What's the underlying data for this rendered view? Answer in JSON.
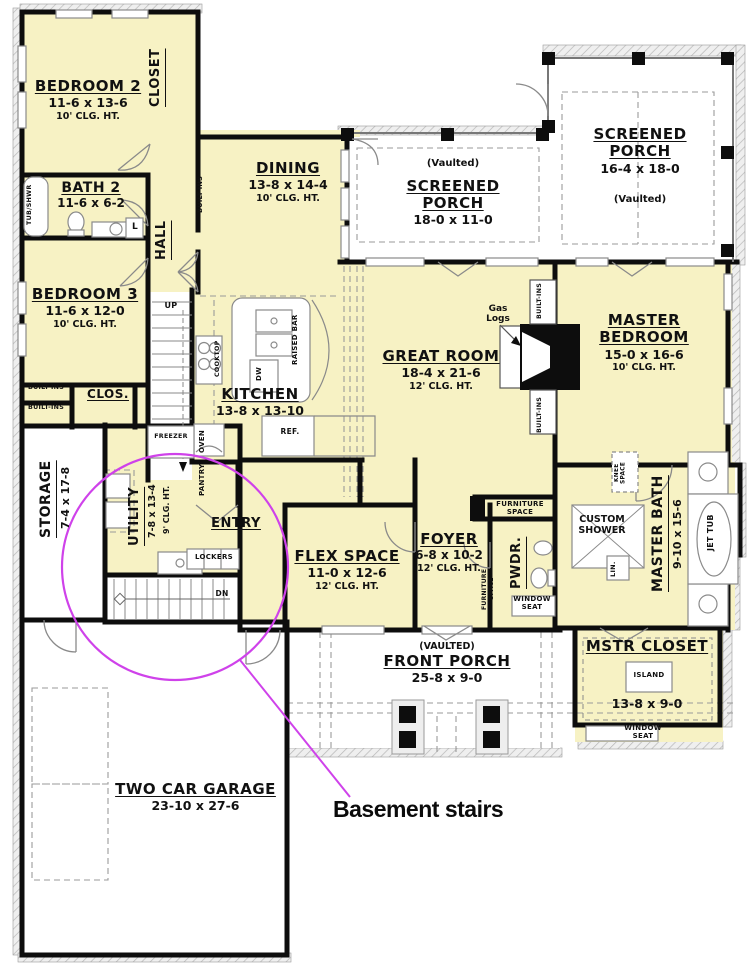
{
  "annotation": {
    "label": "Basement stairs"
  },
  "palette": {
    "room_fill": "#f7f2c4",
    "wall": "#0d0d0d",
    "porch_fill": "#ffffff",
    "annotation": "#cf42ea"
  },
  "rooms": {
    "bedroom2": {
      "name": "BEDROOM 2",
      "dims": "11-6 x 13-6",
      "ceiling": "10' CLG. HT."
    },
    "closet2": {
      "name": "CLOSET"
    },
    "bath2": {
      "name": "BATH 2",
      "dims": "11-6 x 6-2"
    },
    "hall": {
      "name": "HALL"
    },
    "bedroom3": {
      "name": "BEDROOM 3",
      "dims": "11-6 x 12-0",
      "ceiling": "10' CLG. HT."
    },
    "clos3": {
      "name": "CLOS."
    },
    "dining": {
      "name": "DINING",
      "dims": "13-8 x 14-4",
      "ceiling": "10' CLG. HT."
    },
    "screened_porch_center": {
      "name": "SCREENED PORCH",
      "dims": "18-0 x 11-0",
      "note": "(Vaulted)"
    },
    "screened_porch_right": {
      "name": "SCREENED PORCH",
      "dims": "16-4 x 18-0",
      "note": "(Vaulted)"
    },
    "great_room": {
      "name": "GREAT ROOM",
      "dims": "18-4 x 21-6",
      "ceiling": "12' CLG. HT."
    },
    "master_bedroom": {
      "name": "MASTER BEDROOM",
      "dims": "15-0 x 16-6",
      "ceiling": "10' CLG. HT."
    },
    "kitchen": {
      "name": "KITCHEN",
      "dims": "13-8 x 13-10"
    },
    "storage": {
      "name": "STORAGE",
      "dims": "7-4 x 17-8"
    },
    "utility": {
      "name": "UTILITY",
      "dims": "7-8 x 13-4",
      "ceiling": "9' CLG. HT."
    },
    "entry": {
      "name": "ENTRY"
    },
    "flex_space": {
      "name": "FLEX SPACE",
      "dims": "11-0 x 12-6",
      "ceiling": "12' CLG. HT."
    },
    "foyer": {
      "name": "FOYER",
      "dims": "6-8 x 10-2",
      "ceiling": "12' CLG. HT."
    },
    "powder": {
      "name": "PWDR."
    },
    "master_bath": {
      "name": "MASTER BATH",
      "dims": "9-10 x 15-6"
    },
    "custom_shower": {
      "name": "CUSTOM SHOWER"
    },
    "master_closet": {
      "name": "MSTR CLOSET",
      "dims": "13-8 x 9-0"
    },
    "front_porch": {
      "name": "FRONT PORCH",
      "dims": "25-8 x 9-0",
      "note": "(VAULTED)"
    },
    "garage": {
      "name": "TWO CAR GARAGE",
      "dims": "23-10 x 27-6"
    }
  },
  "features": {
    "built_ins": "BUILT-INS",
    "tub_shwr": "TUB/SHWR",
    "linen": "L",
    "up": "UP",
    "dn": "DN",
    "cooktop": "COOKTOP",
    "oven": "OVEN",
    "freezer": "FREEZER",
    "pantry": "PANTRY",
    "refrigerator": "REF.",
    "dishwasher": "DW",
    "raised_bar": "RAISED BAR",
    "lockers": "LOCKERS",
    "gas_logs": "Gas Logs",
    "furniture_space": "FURNITURE SPACE",
    "window_seat": "WINDOW SEAT",
    "knee_space": "KNEE SPACE",
    "lin": "LIN.",
    "jet_tub": "JET TUB",
    "island": "ISLAND"
  }
}
